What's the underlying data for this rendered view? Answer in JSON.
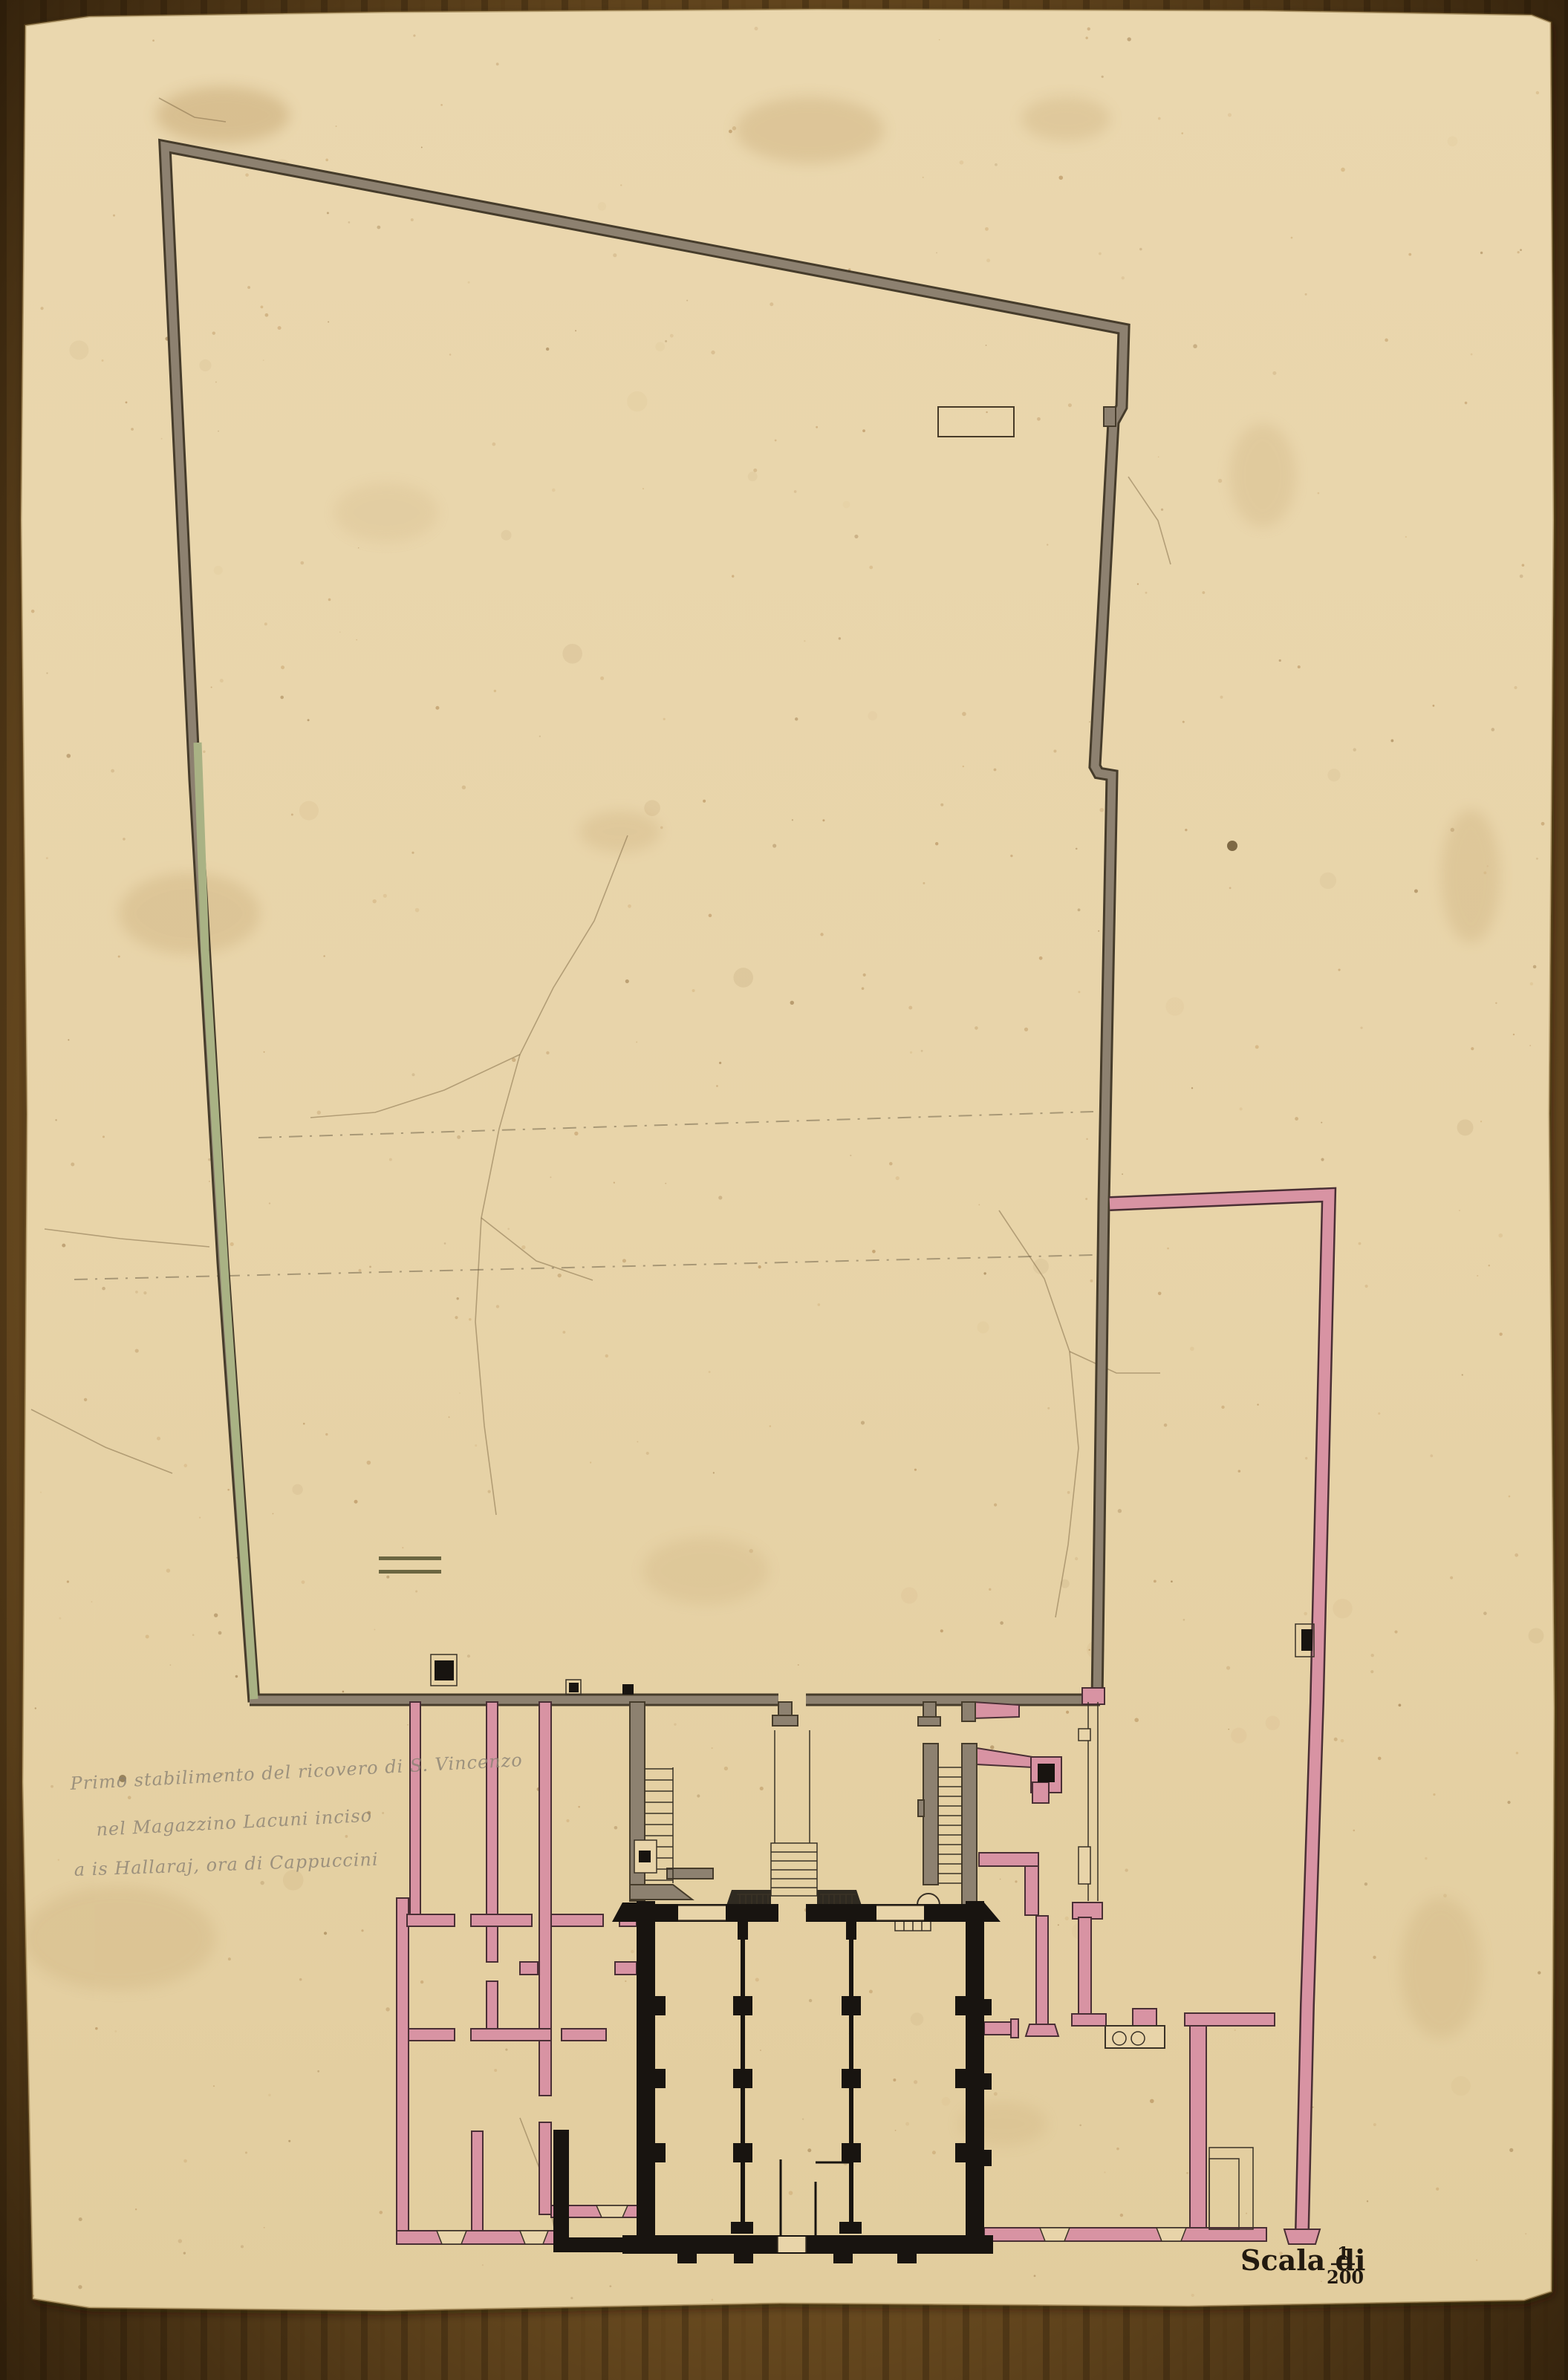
{
  "annotation": {
    "lines": [
      "Primo stabilimento del ricovero di S. Vincenzo",
      "nel Magazzino Lacuni  inciso",
      "a is Hallaraj, ora di Cappuccini"
    ]
  },
  "scale": {
    "prefix": "Scala di",
    "numerator": "1",
    "denominator": "200"
  },
  "colors": {
    "paper": "#e8d4a9",
    "cardboard": "#6f4f22",
    "wall_gray": "#8d8170",
    "wall_green": "#a9b284",
    "wall_pink": "#d893a3",
    "wall_black": "#181410",
    "ink_pink_edge": "#4a2f35",
    "handwriting": "#8b8274",
    "scale_ink": "#221a10"
  }
}
